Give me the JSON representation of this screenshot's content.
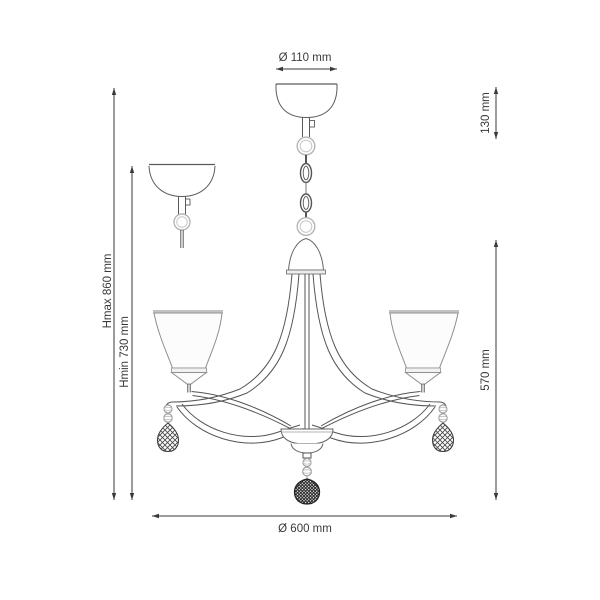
{
  "drawing": {
    "subject": "chandelier-dimension-drawing",
    "style": {
      "line_color": "#3a3a3a",
      "drawing_line_color": "#5a5a5a",
      "light_gray": "#b5b5b5",
      "background": "#ffffff"
    },
    "dimensions": {
      "canopy_diameter": "Ø 110 mm",
      "suspension_length": "130 mm",
      "height_max": "Hmax 860 mm",
      "height_min": "Hmin 730 mm",
      "body_height": "570 mm",
      "fixture_diameter": "Ø 600 mm"
    }
  }
}
